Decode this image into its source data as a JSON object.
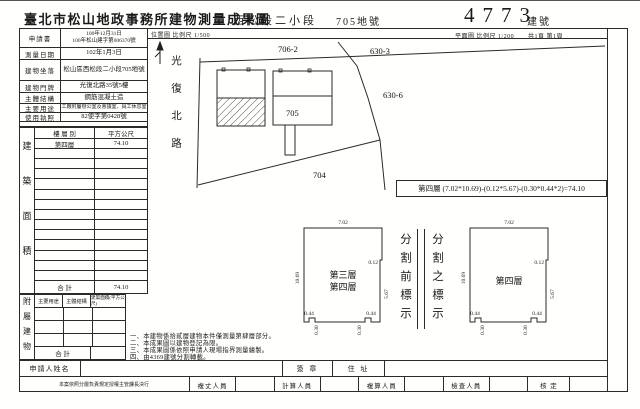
{
  "header": {
    "title": "臺北市松山地政事務所建物測量成果圖",
    "section": "西松段二小段",
    "parcel_no": "705地號",
    "building_no": "4773",
    "building_no_label": "建號",
    "location_scale": "位置圖 比例尺 1/500",
    "plan_scale": "平面圖 比例尺 1/200",
    "pages": "共1頁 第1頁"
  },
  "info": {
    "rows": [
      {
        "label": "申請書",
        "value": "100年12月31日",
        "value2": "100年松山建字第006370號"
      },
      {
        "label": "測量日期",
        "value": "102年1月3日"
      },
      {
        "label": "建物坐落",
        "value": "松山區西松段二小段705地號"
      },
      {
        "label": "建物門牌",
        "value": "光復北路35號5樓"
      },
      {
        "label": "主體結構",
        "value": "鋼筋混凝土造"
      },
      {
        "label": "主要用途",
        "value": "工廠附屬辦公室及會議室、員工休息室"
      },
      {
        "label": "使用執照",
        "value": "82使字第0428號"
      }
    ]
  },
  "floor_area": {
    "side_label": "建築面積",
    "col_floor": "樓 層 別",
    "col_area": "平方公尺",
    "rows": [
      {
        "floor": "第四層",
        "area": "74.10"
      }
    ],
    "total_label": "合 計",
    "total": "74.10"
  },
  "annex": {
    "side_label": "附屬建物",
    "col_use": "主要用途",
    "col_structure": "主體結構",
    "col_area": "建築面積(平方公尺)",
    "total_label": "合 計"
  },
  "site_plan": {
    "road": "光復北路",
    "parcel_706_2": "706-2",
    "parcel_630_3": "630-3",
    "parcel_630_6": "630-6",
    "parcel_705": "705",
    "parcel_704": "704"
  },
  "formula": "第四層 (7.02*10.69)-(0.12*5.67)-(0.30*0.44*2)=74.10",
  "floor_plans": {
    "left_label1": "第三層",
    "left_label2": "第四層",
    "right_label": "第四層",
    "dim_top": "7.02",
    "dim_left": "10.69",
    "dim_step": "0.12",
    "dim_right": "5.67",
    "dim_notch_w": "0.44",
    "dim_notch_d": "0.30",
    "divider_before": "分割前標示",
    "divider_after": "分割之標示"
  },
  "notes": [
    "一、本建物係拾貳層建物本件僅測量第肆層部分。",
    "二、本成果圖以建物登記為限。",
    "三、本成果圖係依照申請人現場指界測量繪製。",
    "四、由4369建號分割轉載。"
  ],
  "signature_row": {
    "applicant_label": "申請人姓名",
    "seal_label": "簽 章",
    "address_label": "住 址"
  },
  "staff_row": {
    "delegate_note": "本案依照分層負責規定授權主管課長決行",
    "roles": [
      "複丈人員",
      "計算人員",
      "複算人員",
      "檢查人員",
      "核 定"
    ]
  }
}
